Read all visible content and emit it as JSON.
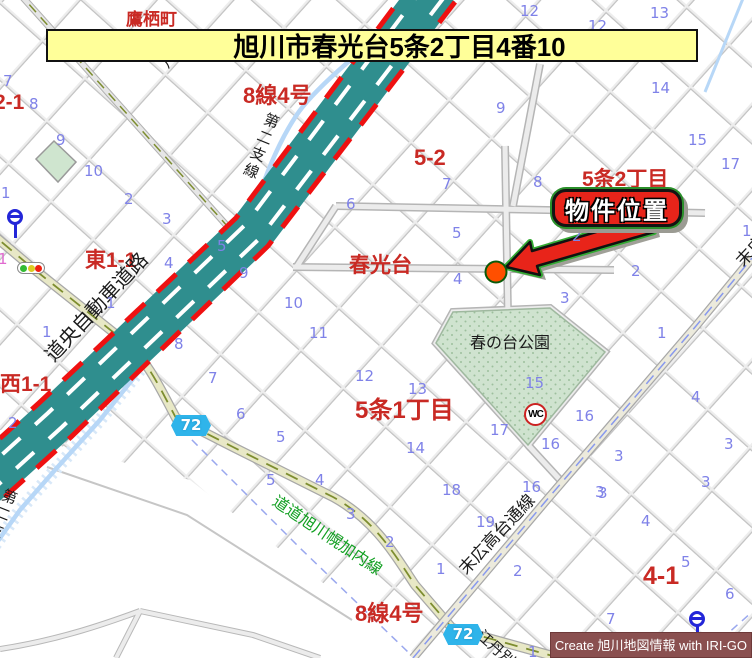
{
  "palette": {
    "red": "#c92a24",
    "blue": "#7f82e8",
    "black": "#1c1c1c",
    "green": "#12a022",
    "pink": "#e06ad0"
  },
  "banner": {
    "title": "旭川市春光台5条2丁目4番10"
  },
  "callout": {
    "label": "物件位置"
  },
  "icons": {
    "wc_label": "WC"
  },
  "credit": {
    "text": "Create 旭川地図情報 with IRI-GO"
  },
  "route_badges": [
    {
      "t": "72",
      "x": 171,
      "y": 415
    },
    {
      "t": "72",
      "x": 443,
      "y": 624
    }
  ],
  "map_labels": [
    {
      "t": "鷹栖町",
      "x": 126,
      "y": 11,
      "c": "red",
      "s": 17,
      "b": 1,
      "n": "district-label-takasucho"
    },
    {
      "t": "8線4号",
      "x": 243,
      "y": 84,
      "c": "red",
      "s": 22,
      "b": 1,
      "n": "road-label-8sen4go-top"
    },
    {
      "t": "八線",
      "x": 158,
      "y": 62,
      "c": "black",
      "s": 15,
      "r": -55,
      "sp": 8,
      "n": "road-label-hassen"
    },
    {
      "t": "第二支線",
      "x": 266,
      "y": 110,
      "c": "black",
      "s": 15,
      "v": 1,
      "r": 22,
      "sp": 3,
      "n": "stream-label-dainishisen-upper"
    },
    {
      "t": "第二支線",
      "x": 4,
      "y": 486,
      "c": "black",
      "s": 15,
      "v": 1,
      "r": 22,
      "sp": 3,
      "n": "stream-label-dainishisen-lower"
    },
    {
      "t": "2-1",
      "x": -6,
      "y": 92,
      "c": "red",
      "s": 21,
      "b": 1,
      "n": "block-label-2-1"
    },
    {
      "t": "5-2",
      "x": 414,
      "y": 146,
      "c": "red",
      "s": 22,
      "b": 1,
      "n": "block-label-5-2"
    },
    {
      "t": "5条2丁目",
      "x": 582,
      "y": 169,
      "c": "red",
      "s": 21,
      "b": 1,
      "n": "district-label-5jo2chome"
    },
    {
      "t": "春光台",
      "x": 349,
      "y": 255,
      "c": "red",
      "s": 21,
      "b": 1,
      "n": "district-label-shunkodai"
    },
    {
      "t": "東1-1",
      "x": 85,
      "y": 250,
      "c": "red",
      "s": 21,
      "b": 1,
      "n": "block-label-higashi1-1"
    },
    {
      "t": "西1-1",
      "x": 0,
      "y": 374,
      "c": "red",
      "s": 21,
      "b": 1,
      "n": "block-label-nishi1-1"
    },
    {
      "t": "5条1丁目",
      "x": 355,
      "y": 398,
      "c": "red",
      "s": 24,
      "b": 1,
      "n": "district-label-5jo1chome"
    },
    {
      "t": "4-1",
      "x": 643,
      "y": 563,
      "c": "red",
      "s": 25,
      "b": 1,
      "n": "block-label-4-1"
    },
    {
      "t": "8線4号",
      "x": 355,
      "y": 602,
      "c": "red",
      "s": 22,
      "b": 1,
      "n": "road-label-8sen4go-bottom"
    },
    {
      "t": "道央自動車道路",
      "x": 42,
      "y": 352,
      "c": "black",
      "s": 20,
      "r": -47,
      "n": "road-label-doo-expressway"
    },
    {
      "t": "春の台公園",
      "x": 470,
      "y": 336,
      "c": "black",
      "s": 16,
      "n": "park-label-harunodai"
    },
    {
      "t": "道道旭川幌加内線",
      "x": 278,
      "y": 494,
      "c": "green",
      "s": 16,
      "r": 34,
      "n": "road-label-horokanai"
    },
    {
      "t": "末広高台通線",
      "x": 456,
      "y": 566,
      "c": "black",
      "s": 17,
      "r": -47,
      "n": "road-label-suehiro-takadai"
    },
    {
      "t": "末広高台通線",
      "x": 733,
      "y": 258,
      "c": "black",
      "s": 17,
      "r": -47,
      "n": "road-label-suehiro-takadai-partial"
    },
    {
      "t": "江丹別",
      "x": 484,
      "y": 628,
      "c": "black",
      "s": 15,
      "r": 42,
      "n": "road-label-etanbetsu"
    }
  ],
  "lot_numbers": [
    {
      "t": "7",
      "x": 3,
      "y": 72
    },
    {
      "t": "8",
      "x": 29,
      "y": 95
    },
    {
      "t": "9",
      "x": 56,
      "y": 131
    },
    {
      "t": "10",
      "x": 84,
      "y": 162
    },
    {
      "t": "2",
      "x": 124,
      "y": 190
    },
    {
      "t": "3",
      "x": 162,
      "y": 210
    },
    {
      "t": "1",
      "x": 1,
      "y": 184
    },
    {
      "t": "6",
      "x": 346,
      "y": 195
    },
    {
      "t": "12",
      "x": 520,
      "y": 2
    },
    {
      "t": "12",
      "x": 588,
      "y": 17
    },
    {
      "t": "13",
      "x": 650,
      "y": 4
    },
    {
      "t": "14",
      "x": 651,
      "y": 79
    },
    {
      "t": "9",
      "x": 496,
      "y": 99
    },
    {
      "t": "15",
      "x": 688,
      "y": 131
    },
    {
      "t": "17",
      "x": 721,
      "y": 155
    },
    {
      "t": "7",
      "x": 442,
      "y": 175
    },
    {
      "t": "8",
      "x": 533,
      "y": 173
    },
    {
      "t": "5",
      "x": 452,
      "y": 224
    },
    {
      "t": "2",
      "x": 572,
      "y": 227
    },
    {
      "t": "4",
      "x": 453,
      "y": 270
    },
    {
      "t": "2",
      "x": 631,
      "y": 262
    },
    {
      "t": "3",
      "x": 560,
      "y": 289
    },
    {
      "t": "1",
      "x": 742,
      "y": 222
    },
    {
      "t": "1",
      "x": 42,
      "y": 323
    },
    {
      "t": "1",
      "x": 106,
      "y": 294
    },
    {
      "t": "4",
      "x": 164,
      "y": 254
    },
    {
      "t": "5",
      "x": 217,
      "y": 237
    },
    {
      "t": "9",
      "x": 239,
      "y": 264
    },
    {
      "t": "10",
      "x": 284,
      "y": 294
    },
    {
      "t": "11",
      "x": 309,
      "y": 324
    },
    {
      "t": "8",
      "x": 174,
      "y": 335
    },
    {
      "t": "7",
      "x": 208,
      "y": 369
    },
    {
      "t": "12",
      "x": 355,
      "y": 367
    },
    {
      "t": "2",
      "x": 8,
      "y": 414
    },
    {
      "t": "1",
      "x": -2,
      "y": 250,
      "c": "pink"
    },
    {
      "t": "6",
      "x": 236,
      "y": 405
    },
    {
      "t": "5",
      "x": 276,
      "y": 428
    },
    {
      "t": "5",
      "x": 266,
      "y": 471
    },
    {
      "t": "4",
      "x": 315,
      "y": 471
    },
    {
      "t": "3",
      "x": 346,
      "y": 505
    },
    {
      "t": "2",
      "x": 385,
      "y": 533
    },
    {
      "t": "1",
      "x": 436,
      "y": 560
    },
    {
      "t": "18",
      "x": 442,
      "y": 481
    },
    {
      "t": "19",
      "x": 476,
      "y": 513
    },
    {
      "t": "16",
      "x": 522,
      "y": 478
    },
    {
      "t": "2",
      "x": 513,
      "y": 562
    },
    {
      "t": "3",
      "x": 595,
      "y": 483
    },
    {
      "t": "13",
      "x": 408,
      "y": 380
    },
    {
      "t": "14",
      "x": 406,
      "y": 439
    },
    {
      "t": "15",
      "x": 525,
      "y": 374
    },
    {
      "t": "17",
      "x": 490,
      "y": 421
    },
    {
      "t": "16",
      "x": 575,
      "y": 407
    },
    {
      "t": "16",
      "x": 541,
      "y": 435
    },
    {
      "t": "1",
      "x": 657,
      "y": 324
    },
    {
      "t": "3",
      "x": 614,
      "y": 447
    },
    {
      "t": "4",
      "x": 691,
      "y": 388
    },
    {
      "t": "3",
      "x": 724,
      "y": 435
    },
    {
      "t": "3",
      "x": 701,
      "y": 473
    },
    {
      "t": "4",
      "x": 641,
      "y": 512
    },
    {
      "t": "3",
      "x": 598,
      "y": 484
    },
    {
      "t": "5",
      "x": 681,
      "y": 553
    },
    {
      "t": "6",
      "x": 725,
      "y": 585
    },
    {
      "t": "7",
      "x": 606,
      "y": 610
    },
    {
      "t": "1",
      "x": 528,
      "y": 643
    }
  ]
}
